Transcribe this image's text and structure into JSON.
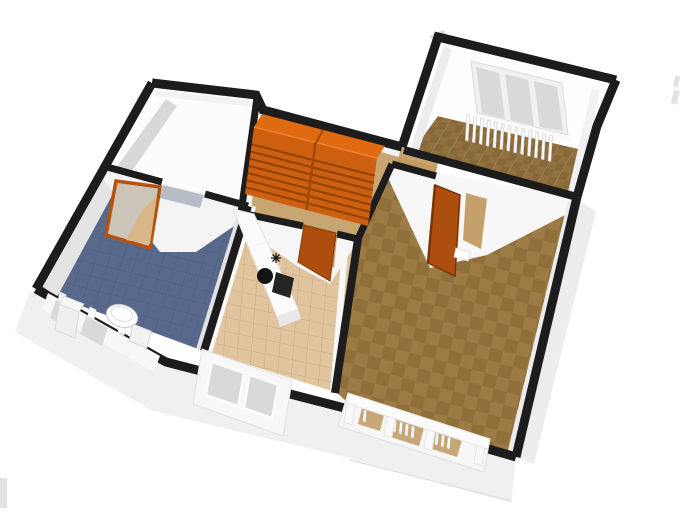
{
  "scene": {
    "view": "aerial oblique 3D rendering of an apartment floor plan",
    "background": "#ffffff"
  },
  "colors": {
    "background": "#ffffff",
    "wall_cap": "#1c1c1c",
    "wall_face": "#fcfcfc",
    "wall_face_light": "#f2f2f2",
    "wall_shadow": "#d8d8d8",
    "wall_shadow_soft": "#e4e4e4",
    "exterior_skirt": "#f0f0f0",
    "exterior_skirt_side": "#ededed",
    "shelf_top": "#e06a10",
    "shelf_front": "#cc5f10",
    "shelf_slat": "#8a3e06",
    "shelf_divider": "#a04a0a",
    "door_orange": "#ad4d0e",
    "door_orange_dark": "#7a3407",
    "door_frame_orange": "#b5520f",
    "door_glass": "#ccc5ba",
    "door_glass_floor": "#d8b687",
    "doorway_floor": "#c6a06b",
    "doorway_shadow": "#b7bcc7",
    "bathroom_floor": "#58698b",
    "bathroom_grid": "#4b5d7e",
    "kitchen_floor": "#e0c59e",
    "kitchen_grid": "#cbab80",
    "hall_floor": "#c8a671",
    "living_floor_a": "#9d7b45",
    "living_floor_b": "#8f703b",
    "tr_floor_a": "#927040",
    "tr_floor_b": "#876838",
    "window_glass": "#d9d9d9",
    "window_frame": "#f6f6f6",
    "fixture_white": "#f7f7f7",
    "fixture_edge": "#cfcfcf",
    "cooktop_black": "#242424",
    "sink_black": "#141414",
    "artifact_gray": "#e3e3e3"
  },
  "rooms": [
    {
      "id": "room-top-left",
      "name": "Empty room (top left)",
      "floor": "white"
    },
    {
      "id": "hallway",
      "name": "Hallway",
      "floor": "light wood"
    },
    {
      "id": "room-top-right",
      "name": "Room (top right)",
      "floor": "brown tile"
    },
    {
      "id": "bathroom",
      "name": "Bathroom",
      "floor": "blue tile"
    },
    {
      "id": "kitchen",
      "name": "Kitchen",
      "floor": "beige tile"
    },
    {
      "id": "living-room",
      "name": "Living room (right)",
      "floor": "brown parquet"
    }
  ],
  "furniture": [
    {
      "id": "bookshelf",
      "label": "Orange double bookshelf",
      "room": "hallway"
    },
    {
      "id": "kitchen-counter",
      "label": "Kitchen counter with sink, burner and oven",
      "room": "kitchen"
    },
    {
      "id": "toilet",
      "label": "Toilet",
      "room": "bathroom"
    },
    {
      "id": "washbasin",
      "label": "Washbasin",
      "room": "bathroom"
    },
    {
      "id": "radiator-top-right",
      "label": "Radiator under window",
      "room": "room-top-right"
    },
    {
      "id": "radiator-living",
      "label": "Radiator behind window",
      "room": "living-room"
    }
  ],
  "doors": [
    {
      "id": "bathroom-glass-door",
      "label": "Glass door with orange frame",
      "state": "open"
    },
    {
      "id": "kitchen-door",
      "label": "Orange door",
      "state": "open"
    },
    {
      "id": "living-room-door",
      "label": "Orange door",
      "state": "open"
    }
  ],
  "windows": [
    {
      "id": "top-right-window",
      "panes": 3
    },
    {
      "id": "bathroom-window",
      "panes": 2
    },
    {
      "id": "kitchen-window",
      "panes": 2
    },
    {
      "id": "living-room-window",
      "panes": 3
    }
  ],
  "radiators": {
    "top_right_fins": 13,
    "living_window_fins": [
      1,
      4,
      3
    ]
  },
  "shelf": {
    "columns": 2,
    "slats_per_column": 7
  }
}
